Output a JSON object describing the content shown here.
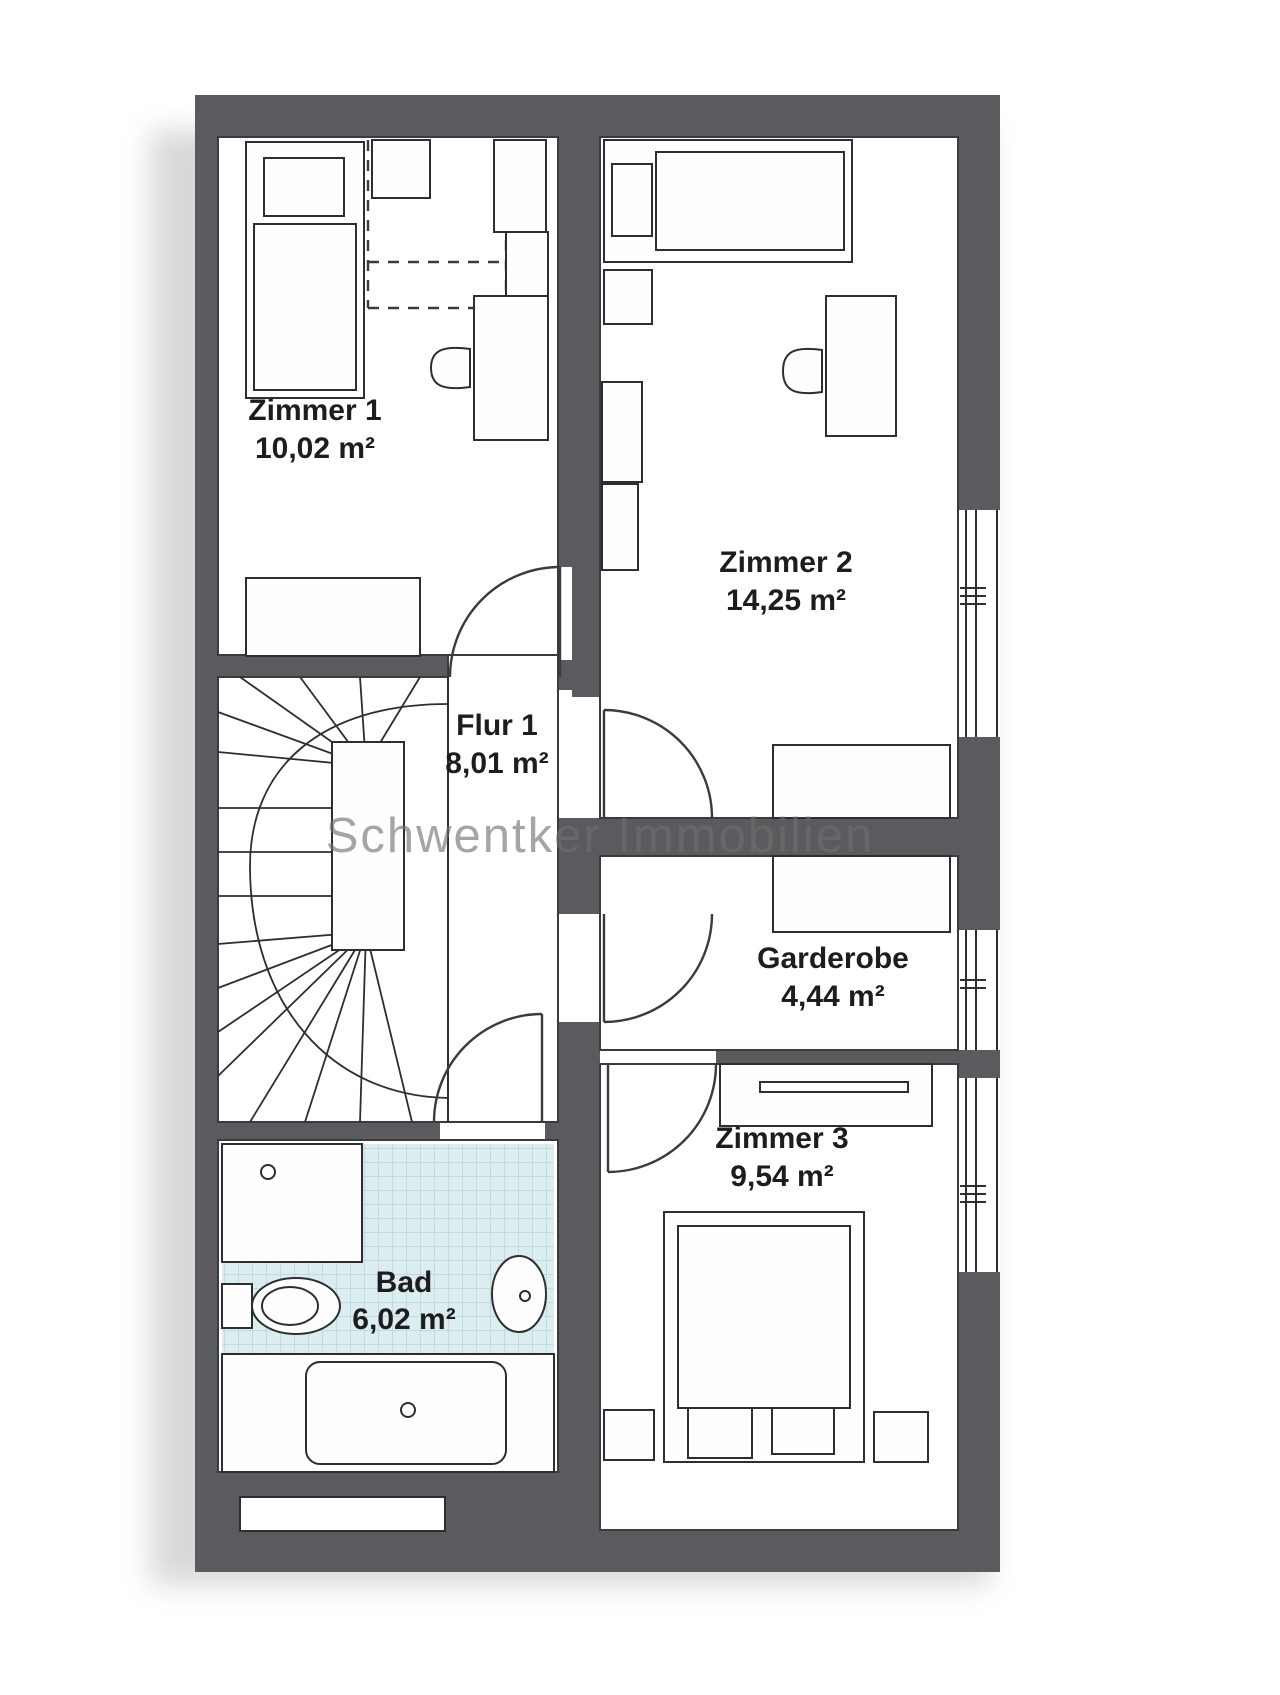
{
  "watermark": {
    "text": "Schwentker Immobilien"
  },
  "plan": {
    "rooms": [
      {
        "id": "zimmer1",
        "name": "Zimmer 1",
        "area": "10,02 m²"
      },
      {
        "id": "zimmer2",
        "name": "Zimmer 2",
        "area": "14,25 m²"
      },
      {
        "id": "flur1",
        "name": "Flur 1",
        "area": "8,01 m²"
      },
      {
        "id": "garderobe",
        "name": "Garderobe",
        "area": "4,44 m²"
      },
      {
        "id": "zimmer3",
        "name": "Zimmer 3",
        "area": "9,54 m²"
      },
      {
        "id": "bad",
        "name": "Bad",
        "area": "6,02 m²"
      }
    ],
    "colors": {
      "wall": "#5a5b5e",
      "line": "#2e2e30",
      "bath_tile": "#dcedf0",
      "bath_tile_line": "#b7d4da",
      "watermark": "#6f6f6f",
      "paper": "#ffffff"
    }
  }
}
